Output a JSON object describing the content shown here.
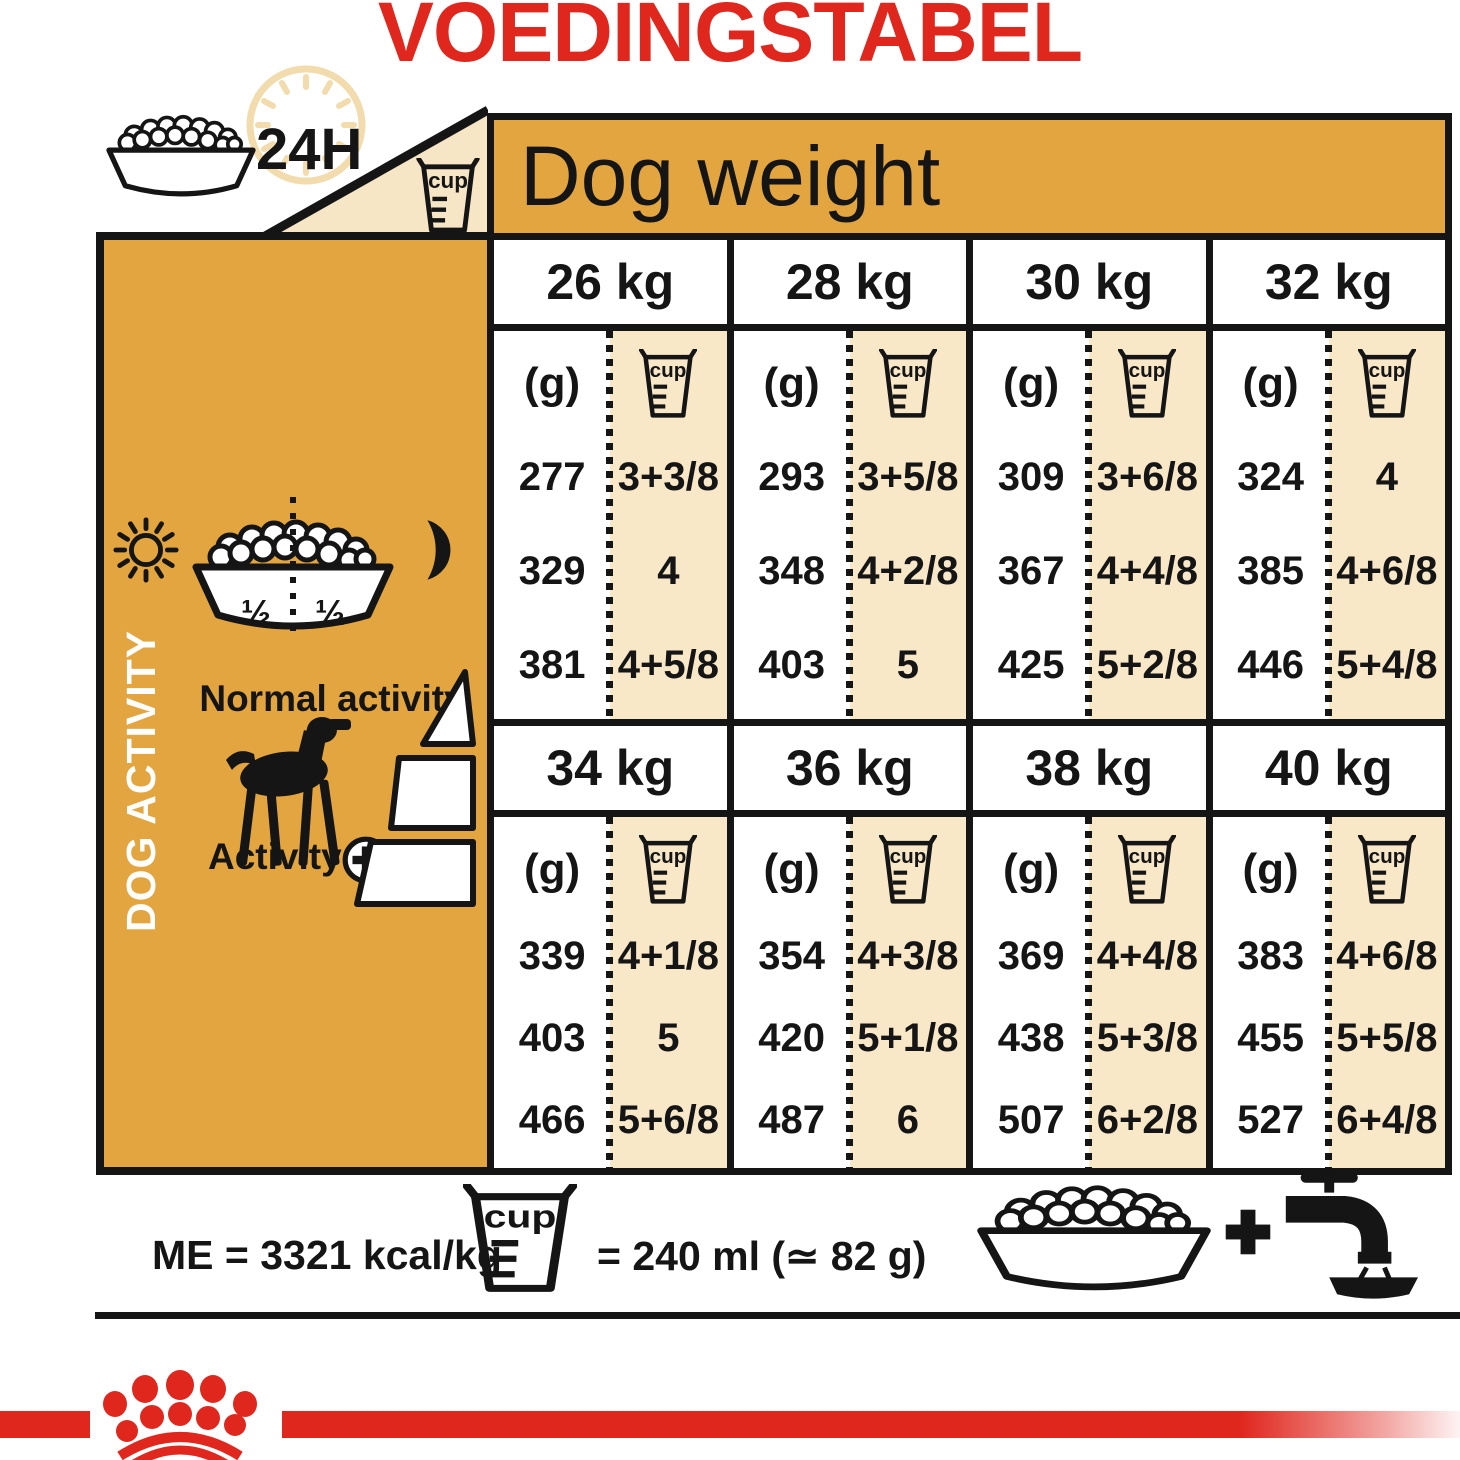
{
  "title": {
    "text": "VOEDINGSTABEL"
  },
  "top_header": {
    "h24_label": "24H",
    "dog_weight_label": "Dog weight"
  },
  "table": {
    "unit_label": "(g)",
    "cup_label": "cup",
    "sections": [
      {
        "weight": "26 kg",
        "rows": [
          {
            "g": "277",
            "cup": "3+3/8"
          },
          {
            "g": "329",
            "cup": "4"
          },
          {
            "g": "381",
            "cup": "4+5/8"
          }
        ]
      },
      {
        "weight": "28 kg",
        "rows": [
          {
            "g": "293",
            "cup": "3+5/8"
          },
          {
            "g": "348",
            "cup": "4+2/8"
          },
          {
            "g": "403",
            "cup": "5"
          }
        ]
      },
      {
        "weight": "30 kg",
        "rows": [
          {
            "g": "309",
            "cup": "3+6/8"
          },
          {
            "g": "367",
            "cup": "4+4/8"
          },
          {
            "g": "425",
            "cup": "5+2/8"
          }
        ]
      },
      {
        "weight": "32 kg",
        "rows": [
          {
            "g": "324",
            "cup": "4"
          },
          {
            "g": "385",
            "cup": "4+6/8"
          },
          {
            "g": "446",
            "cup": "5+4/8"
          }
        ]
      },
      {
        "weight": "34 kg",
        "rows": [
          {
            "g": "339",
            "cup": "4+1/8"
          },
          {
            "g": "403",
            "cup": "5"
          },
          {
            "g": "466",
            "cup": "5+6/8"
          }
        ]
      },
      {
        "weight": "36 kg",
        "rows": [
          {
            "g": "354",
            "cup": "4+3/8"
          },
          {
            "g": "420",
            "cup": "5+1/8"
          },
          {
            "g": "487",
            "cup": "6"
          }
        ]
      },
      {
        "weight": "38 kg",
        "rows": [
          {
            "g": "369",
            "cup": "4+4/8"
          },
          {
            "g": "438",
            "cup": "5+3/8"
          },
          {
            "g": "507",
            "cup": "6+2/8"
          }
        ]
      },
      {
        "weight": "40 kg",
        "rows": [
          {
            "g": "383",
            "cup": "4+6/8"
          },
          {
            "g": "455",
            "cup": "5+5/8"
          },
          {
            "g": "527",
            "cup": "6+4/8"
          }
        ]
      }
    ]
  },
  "activity_panel": {
    "vertical_label": "DOG ACTIVITY",
    "bowl_left_half": "½",
    "bowl_right_half": "½",
    "normal_activity_label": "Normal activity",
    "activity_label": "Activity",
    "activity_plus": "+"
  },
  "footer": {
    "me_text": "ME = 3321 kcal/kg",
    "cup_equivalence": "= 240 ml (≃ 82 g)"
  },
  "colors": {
    "brand_red": "#E0271E",
    "gold": "#E2A540",
    "cream": "#F8E8C8",
    "ink": "#151515"
  }
}
